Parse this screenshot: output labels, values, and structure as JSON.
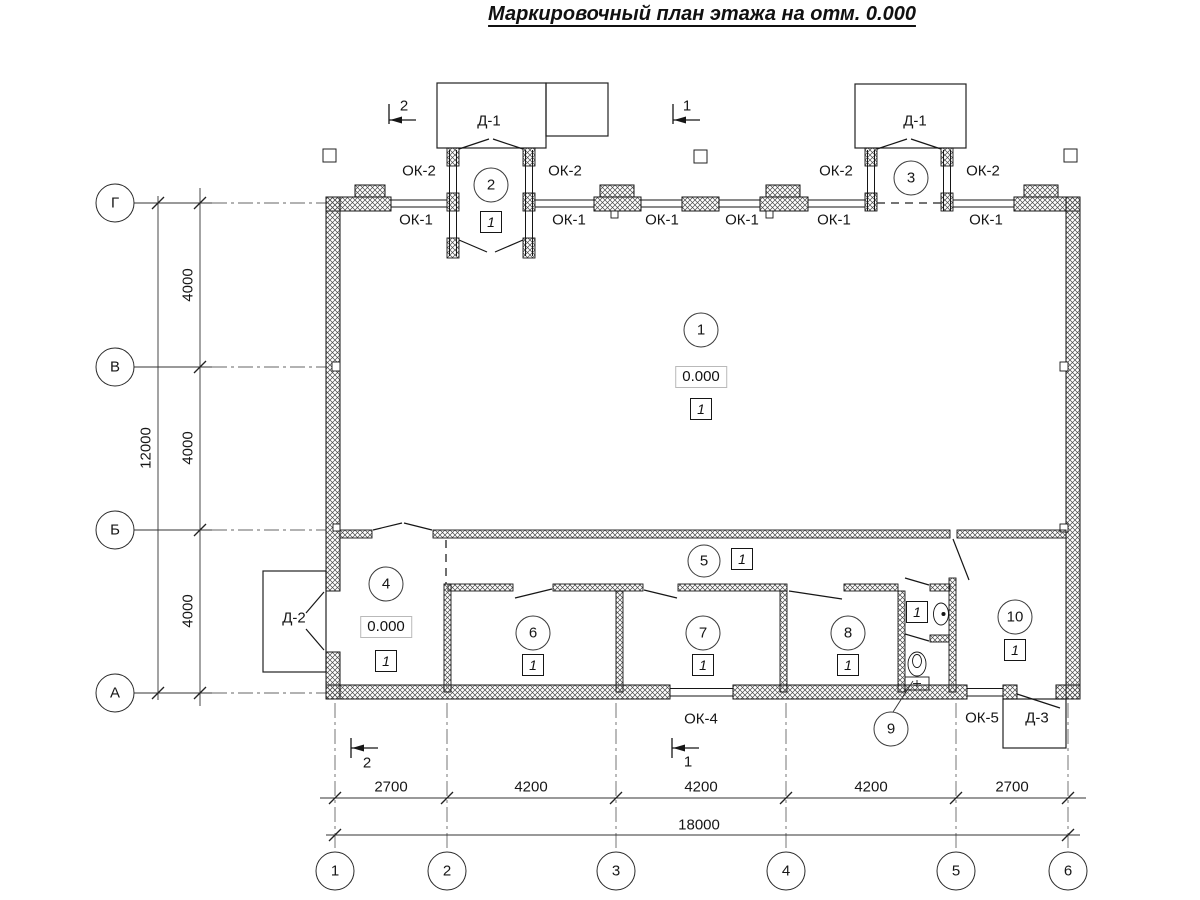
{
  "title": "Маркировочный план этажа на отм. 0.000",
  "grid": {
    "rows": [
      "Г",
      "В",
      "Б",
      "А"
    ],
    "cols": [
      "1",
      "2",
      "3",
      "4",
      "5",
      "6"
    ]
  },
  "dimensions": {
    "vertical": [
      "4000",
      "4000",
      "4000"
    ],
    "vertical_total": "12000",
    "horizontal": [
      "2700",
      "4200",
      "4200",
      "4200",
      "2700"
    ],
    "horizontal_total": "18000"
  },
  "rooms": [
    "1",
    "2",
    "3",
    "4",
    "5",
    "6",
    "7",
    "8",
    "9",
    "10"
  ],
  "floor_mark": "1",
  "elevation_mark": "0.000",
  "openings": {
    "ok1": "ОК-1",
    "ok2": "ОК-2",
    "ok4": "ОК-4",
    "ok5": "ОК-5",
    "d1": "Д-1",
    "d2": "Д-2",
    "d3": "Д-3"
  },
  "section_marks": {
    "s1": "1",
    "s2": "2"
  }
}
